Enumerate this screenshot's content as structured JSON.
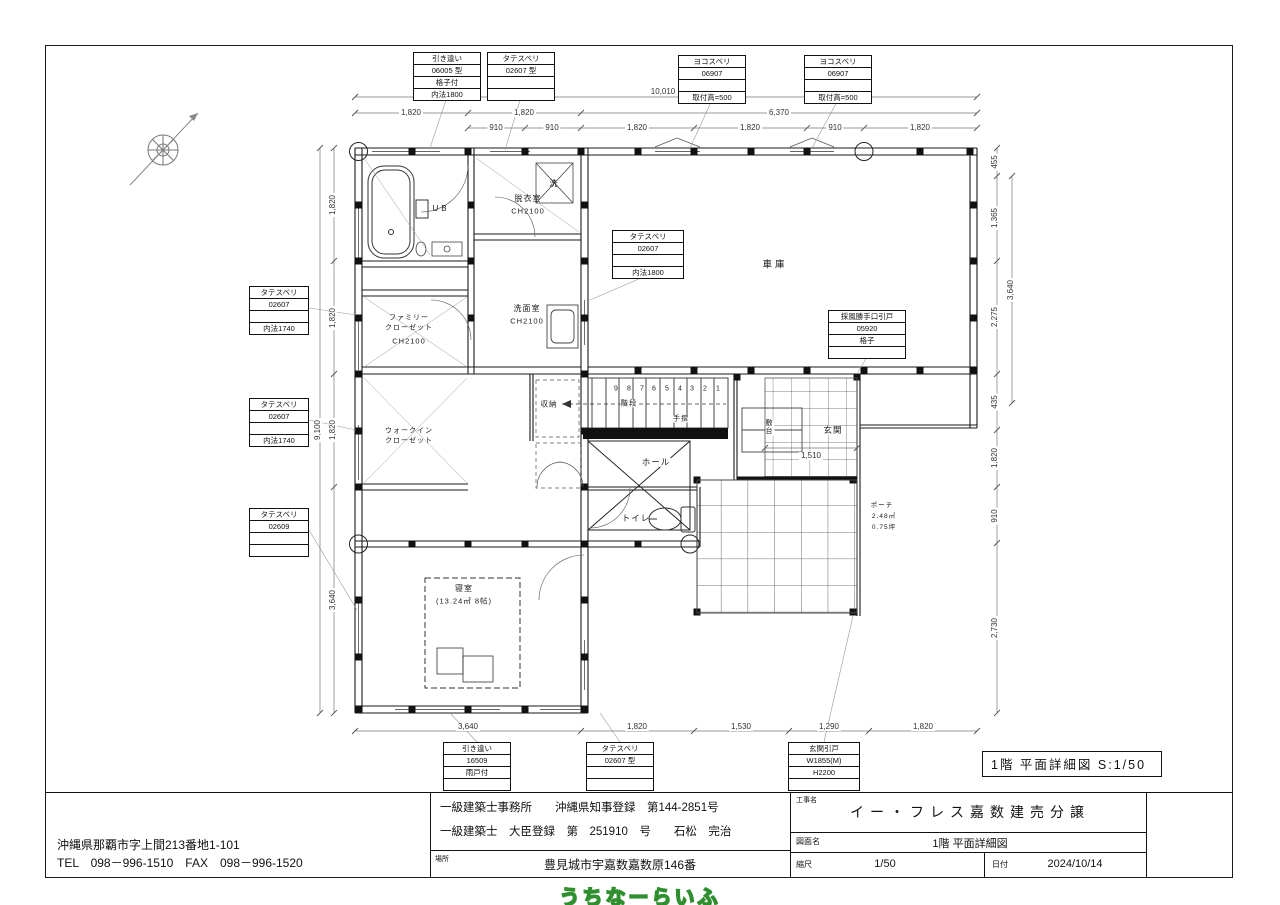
{
  "page": {
    "drawing_title": "1階 平面詳細図 S:1/50",
    "watermark": "うちなーらいふ"
  },
  "dims": {
    "top_total": "10,010",
    "top_row1": [
      "1,820",
      "1,820",
      "6,370"
    ],
    "top_row2": [
      "910",
      "910",
      "1,820",
      "1,820",
      "910",
      "1,820"
    ],
    "bottom": [
      "3,640",
      "1,820",
      "1,530",
      "1,290",
      "1,820"
    ],
    "left_total": "9,100",
    "left": [
      "1,820",
      "1,820",
      "1,820",
      "3,640"
    ],
    "right": [
      "455",
      "1,365",
      "2,275",
      "435",
      "1,820",
      "910",
      "2,730"
    ],
    "right_outer": "3,640",
    "genkan_width": "1,510"
  },
  "spec_boxes": {
    "top1": [
      "引き違い",
      "06005 型",
      "格子付",
      "内法1800"
    ],
    "top2": [
      "タテスベリ",
      "02607 型",
      "",
      ""
    ],
    "top3": [
      "ヨコスベリ",
      "06907",
      "",
      "取付高=500"
    ],
    "top4": [
      "ヨコスベリ",
      "06907",
      "",
      "取付高=500"
    ],
    "left1": [
      "タテスベリ",
      "02607",
      "",
      "内法1740"
    ],
    "left2": [
      "タテスベリ",
      "02607",
      "",
      "内法1740"
    ],
    "left3": [
      "タテスベリ",
      "02609",
      "",
      ""
    ],
    "mid1": [
      "タテスベリ",
      "02607",
      "",
      "内法1800"
    ],
    "mid2": [
      "採風勝手口引戸",
      "05920",
      "格子",
      ""
    ],
    "bottom1": [
      "引き違い",
      "16509",
      "雨戸付",
      ""
    ],
    "bottom2": [
      "タテスベリ",
      "02607 型",
      "",
      ""
    ],
    "bottom3": [
      "玄関引戸",
      "W1855(M)",
      "H2200",
      ""
    ]
  },
  "rooms": {
    "ub": "UB",
    "datsui": "脱衣室",
    "datsui_ch": "CH2100",
    "washer": "洗",
    "senmen": "洗面室",
    "senmen_ch": "CH2100",
    "fc1": "ファミリー",
    "fc2": "クローゼット",
    "fc_ch": "CH2100",
    "wic1": "ウォークイン",
    "wic2": "クローゼット",
    "shuno": "収納",
    "kaidan": "階段",
    "tesuri": "手摺",
    "hall": "ホール",
    "toilet": "トイレ",
    "garage": "車庫",
    "genkan": "玄関",
    "shikidai": "敷台",
    "porch1": "ポーチ",
    "porch2": "2.48㎡",
    "porch3": "0.75坪",
    "bedroom": "寝室",
    "bedroom_size": "(13.24㎡ 8帖)"
  },
  "stairs": [
    "9",
    "8",
    "7",
    "6",
    "5",
    "4",
    "3",
    "2",
    "1"
  ],
  "title_block": {
    "address1": "沖縄県那覇市字上間213番地1-101",
    "address2": "TEL　098－996-1510　FAX　098－996-1520",
    "license1": "一級建築士事務所　　沖縄県知事登録　第144-2851号",
    "license2": "一級建築士　大臣登録　第　251910　号　　石松　完治",
    "location_label": "場所",
    "location": "豊見城市宇嘉数嘉数原146番",
    "project_label": "工事名",
    "project": "イー・フレス嘉数建売分譲",
    "sheet_label": "図面名",
    "sheet": "1階 平面詳細図",
    "scale_label": "縮尺",
    "scale": "1/50",
    "date_label": "日付",
    "date": "2024/10/14"
  }
}
